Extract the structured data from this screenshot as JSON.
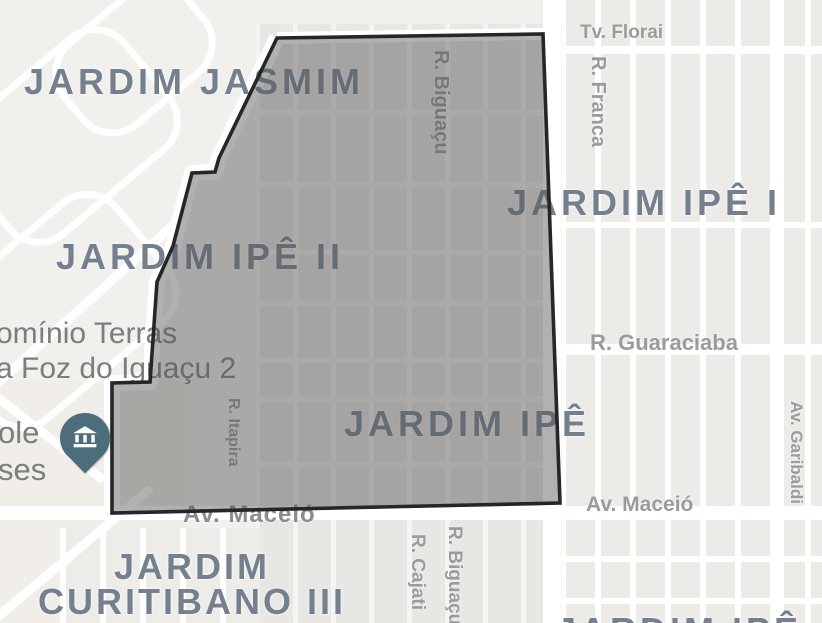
{
  "viewport": {
    "kind": "map",
    "description": "Street map with a highlighted neighborhood polygon (Jardim Ipê II area)"
  },
  "districts": {
    "jasmim": "JARDIM JASMIM",
    "ipe2": "JARDIM IPÊ II",
    "ipe1": "JARDIM IPÊ I",
    "ipe": "JARDIM IPÊ",
    "curitibano_line1": "JARDIM",
    "curitibano_line2": "CURITIBANO III",
    "ipe_bottom": "JARDIM IPÊ"
  },
  "streets": {
    "tv_florai": "Tv. Florai",
    "r_franca": "R. Franca",
    "r_biguacu_top": "R. Biguaçu",
    "r_guaraciaba": "R. Guaraciaba",
    "av_maceio_left": "Av. Maceió",
    "av_maceio_right": "Av. Maceió",
    "av_garibaldi": "Av. Garibaldi",
    "r_itapira": "R. Itapira",
    "r_cajati": "R. Cajati",
    "r_biguacu_bottom": "R. Biguaçu"
  },
  "pois": {
    "condominio_line1": "omínio Terras",
    "condominio_line2": "a Foz do Iguaçu 2",
    "poi_left_line1": "ole",
    "poi_left_line2": "ses",
    "pin_icon": "museum-icon"
  },
  "overlay": {
    "points": "277,38 543,34 560,503 112,513 112,383 150,382 157,282 173,246 192,173 215,172 219,158",
    "fill": "rgba(85,85,85,0.46)",
    "stroke": "#262626",
    "stroke_width": "3.6"
  },
  "colors": {
    "map_base": "#f2f0ed",
    "block_fill": "#ecebe8",
    "road": "#ffffff",
    "district_label": "#74808e",
    "street_label": "#9b9b9b",
    "poi_label": "#7d7d7d",
    "pin": "#4e6d7c",
    "overlay_outline": "#262626"
  }
}
